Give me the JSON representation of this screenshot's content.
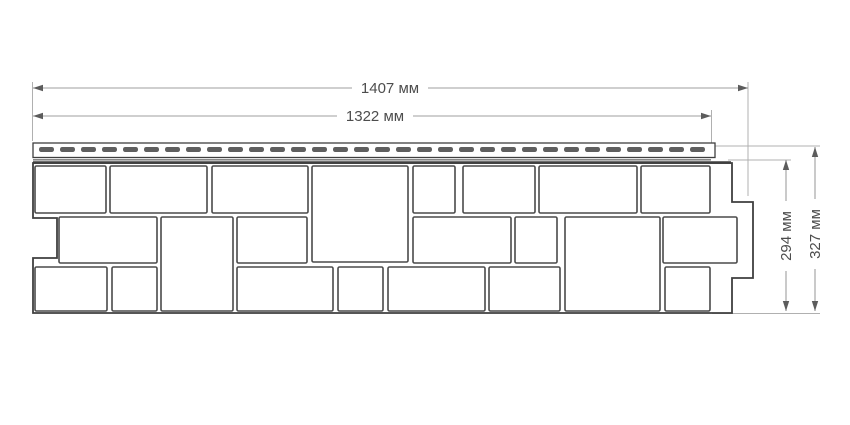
{
  "diagram": {
    "type": "technical-drawing",
    "subject": "facade-siding-panel-with-stone-pattern",
    "dimensions": {
      "width_outer": {
        "label": "1407 мм",
        "value": 1407,
        "unit": "мм"
      },
      "width_inner": {
        "label": "1322 мм",
        "value": 1322,
        "unit": "мм"
      },
      "height_inner": {
        "label": "294 мм",
        "value": 294,
        "unit": "мм"
      },
      "height_outer": {
        "label": "327 мм",
        "value": 327,
        "unit": "мм"
      }
    },
    "colors": {
      "outline": "#3f3f3f",
      "stone": "#4a4a4a",
      "dim": "#9f9f9f",
      "ext": "#b0b0b0",
      "arrow": "#5c5c5c",
      "text": "#4d4d4d",
      "slot": "#5f5f5f",
      "fill": "#ffffff"
    },
    "nail_strip": {
      "slot_count": 32,
      "start_x": 39,
      "y": 147,
      "slot_width": 15,
      "slot_height": 5,
      "pitch": 21
    },
    "stones": [
      [
        35,
        166,
        71,
        47
      ],
      [
        110,
        166,
        97,
        47
      ],
      [
        212,
        166,
        96,
        47
      ],
      [
        312,
        166,
        96,
        96
      ],
      [
        413,
        166,
        42,
        47
      ],
      [
        463,
        166,
        72,
        47
      ],
      [
        539,
        166,
        98,
        47
      ],
      [
        641,
        166,
        69,
        47
      ],
      [
        59,
        217,
        98,
        46
      ],
      [
        161,
        217,
        72,
        94
      ],
      [
        237,
        217,
        70,
        46
      ],
      [
        413,
        217,
        98,
        46
      ],
      [
        515,
        217,
        42,
        46
      ],
      [
        565,
        217,
        95,
        94
      ],
      [
        663,
        217,
        74,
        46
      ],
      [
        35,
        267,
        72,
        44
      ],
      [
        112,
        267,
        45,
        44
      ],
      [
        237,
        267,
        96,
        44
      ],
      [
        338,
        267,
        45,
        44
      ],
      [
        388,
        267,
        97,
        44
      ],
      [
        489,
        267,
        71,
        44
      ],
      [
        665,
        267,
        45,
        44
      ]
    ]
  }
}
